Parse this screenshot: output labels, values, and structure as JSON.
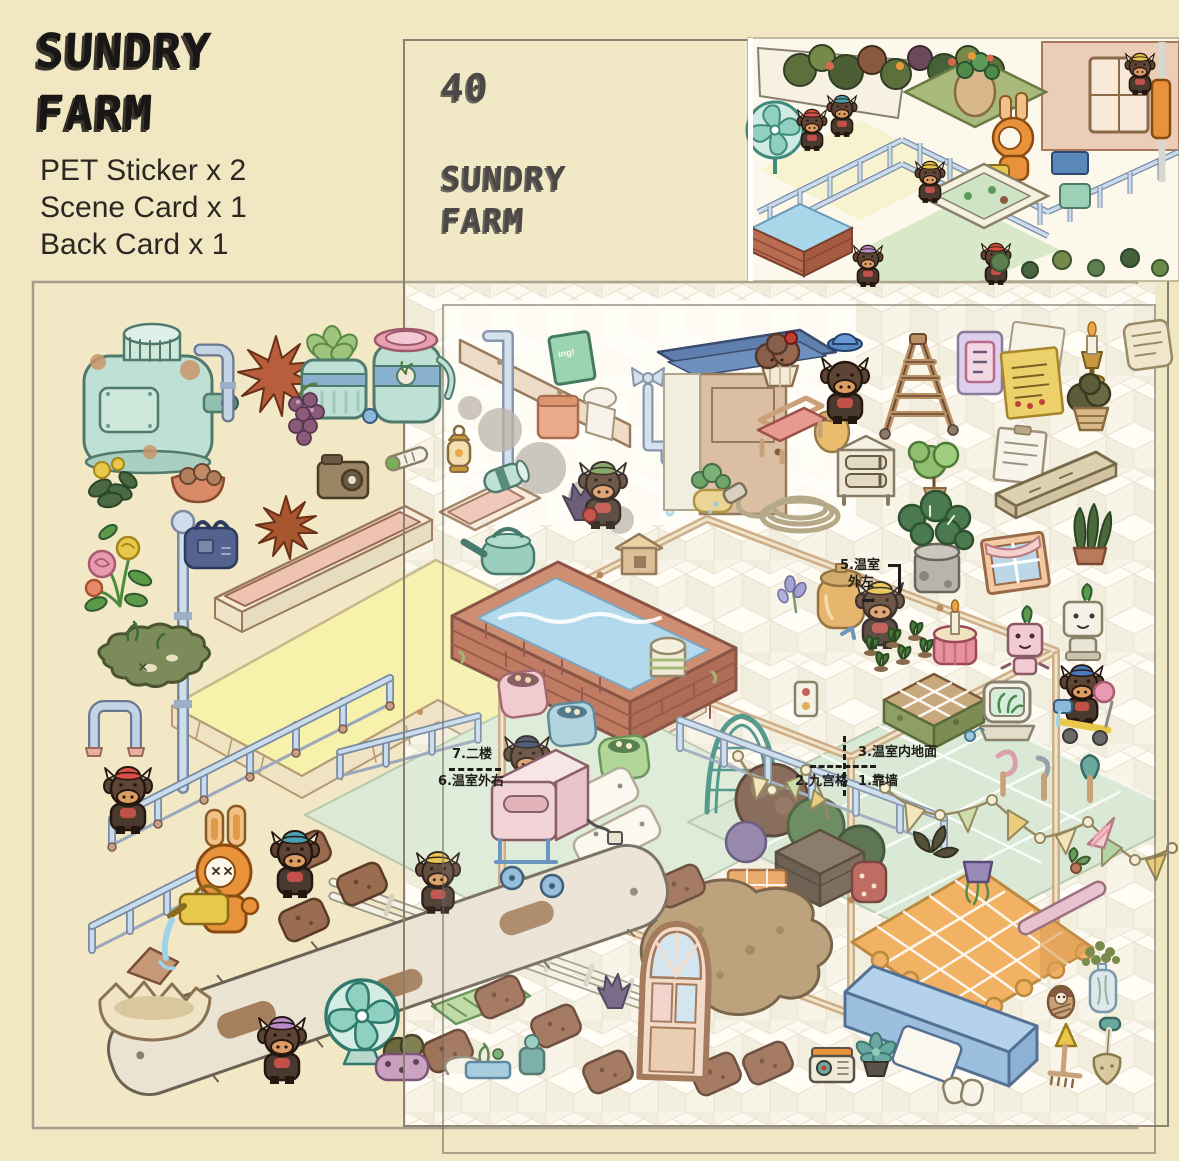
{
  "page": {
    "background": "#f1e7c2"
  },
  "branding": {
    "title_line1": "SUNDRY",
    "title_line2": "FARM",
    "contents": [
      "PET Sticker x 2",
      "Scene Card x 1",
      "Back Card x 1"
    ]
  },
  "card": {
    "number": "40",
    "title_line1": "SUNDRY",
    "title_line2": "FARM"
  },
  "annotations": {
    "a5_line1": "5.温室",
    "a5_line2": "外左",
    "a7": "7.二楼",
    "a6": "6.温室外右",
    "a3": "3.温室内地面",
    "a2": "2.九宫格",
    "a1": "1.靠墙"
  },
  "scene_texts": {
    "hanging_sign": "ing!"
  },
  "colors": {
    "background": "#f1e7c2",
    "sheet_border": "#a69e8d",
    "card_border": "#8a8172",
    "cube_top": "#fffdf6",
    "cube_left": "#f2ecda",
    "cube_right": "#f9f4e6",
    "mint": "#bfe0d4",
    "railing_blue": "#c9dcee",
    "floor_yellow": "#f6f1ab",
    "floor_mint": "#dcead5",
    "brick": "#c9805f",
    "water": "#aad6ea",
    "cow_brown": "#5d4434",
    "robot_orange": "#e8923c",
    "blanket_orange": "#f2a950",
    "bench_blue": "#abcde9",
    "label_ink": "#1f1d1a"
  },
  "sticker_inventory": [
    "water-tank",
    "pipe",
    "star-leaf",
    "succulent-jar",
    "berries",
    "water-jug",
    "flower-bunch",
    "moss-patch",
    "basket-bowl",
    "camera-box",
    "thermometer",
    "lantern",
    "blue-bag",
    "muffin",
    "cow-blue-hat",
    "ladder",
    "poster",
    "sticky-notes",
    "candlestick",
    "paper-scroll",
    "plant-basket",
    "wood-bench",
    "nightstand",
    "potted-plant",
    "note-list",
    "plank",
    "hose-coil",
    "monstera",
    "snake-plant",
    "window-curtain",
    "candle-pot",
    "seedlings",
    "pink-robot",
    "white-robot",
    "nine-grid-tray",
    "plant-terrarium",
    "cow-scooter",
    "garden-hook",
    "hand-hook",
    "trowel",
    "striped-cone",
    "hanging-pot",
    "pink-rod",
    "vase-flowers",
    "nesting-doll",
    "rake",
    "shovel",
    "radio",
    "succulent",
    "gloves",
    "pennant-garland",
    "brick-pool",
    "greenhouse-frame",
    "arched-door",
    "blue-bench",
    "checkered-blanket",
    "fan",
    "log-plank",
    "egg-shell",
    "dirt-patch",
    "rabbit-robot",
    "watering-can",
    "cow-characters"
  ]
}
